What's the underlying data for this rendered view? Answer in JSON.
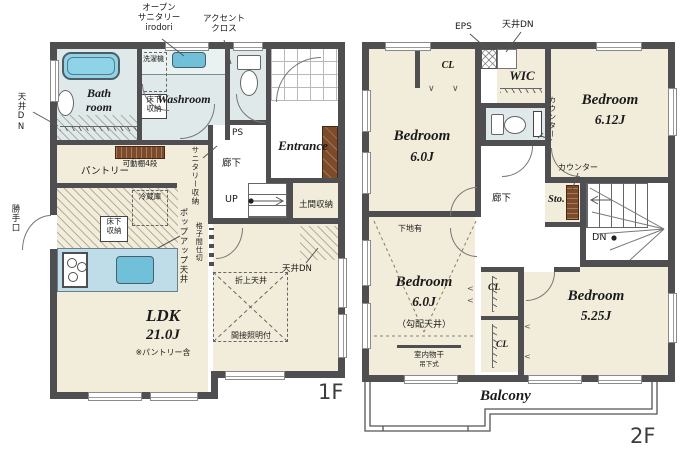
{
  "colors": {
    "wall": "#4f4f51",
    "floor_cream": "#f2ecda",
    "wet_blue": "#dfe9e9",
    "water_blue": "#6fc0d8",
    "wood_brown": "#7d4a2a"
  },
  "floor1": {
    "label": "1F",
    "annotations": {
      "open_sanitary": "オープン\nサニタリー\nirodori",
      "accent_cross": "アクセント\nクロス"
    },
    "rooms": {
      "bath": "Bath\nroom",
      "washroom": "Washroom",
      "pantry": "パントリー",
      "corridor": "廊下",
      "entrance": "Entrance",
      "doma_storage": "土間収納",
      "ldk": "LDK",
      "ldk_size": "21.0J",
      "ldk_note": "※パントリー含"
    },
    "features": {
      "washer": "洗濯機",
      "underfloor_wash": "床下\n収納",
      "underfloor_kitchen": "床下\n収納",
      "ceiling_dn_left": "天井DN",
      "ceiling_dn_right": "天井DN",
      "movable_shelf": "可動棚4段",
      "sanitary_storage": "サニタリー収納",
      "ps": "PS",
      "up": "UP",
      "back_door": "勝手口",
      "fridge": "冷蔵庫",
      "popup_ceiling": "ポップアップ天井",
      "lattice_partition": "格子間仕切",
      "coffered_ceiling": "折上天井",
      "indirect_light": "間接照明付"
    }
  },
  "floor2": {
    "label": "2F",
    "rooms": {
      "bedroom_nw": "Bedroom",
      "bedroom_nw_size": "6.0J",
      "bedroom_ne": "Bedroom",
      "bedroom_ne_size": "6.12J",
      "bedroom_sw": "Bedroom",
      "bedroom_sw_size": "6.0J",
      "bedroom_sw_note": "（勾配天井）",
      "bedroom_se": "Bedroom",
      "bedroom_se_size": "5.25J",
      "wic": "WIC",
      "corridor": "廊下",
      "storage": "Sto.",
      "balcony": "Balcony",
      "cl_top": "CL",
      "cl_mid": "CL",
      "cl_bottom": "CL"
    },
    "features": {
      "eps": "EPS",
      "ceiling_dn": "天井DN",
      "counter_toilet": "カウンター",
      "counter_storage": "カウンター",
      "dn": "DN",
      "wall_backing": "下地有",
      "indoor_drying": "室内物干",
      "hanging_type": "吊下式"
    }
  }
}
